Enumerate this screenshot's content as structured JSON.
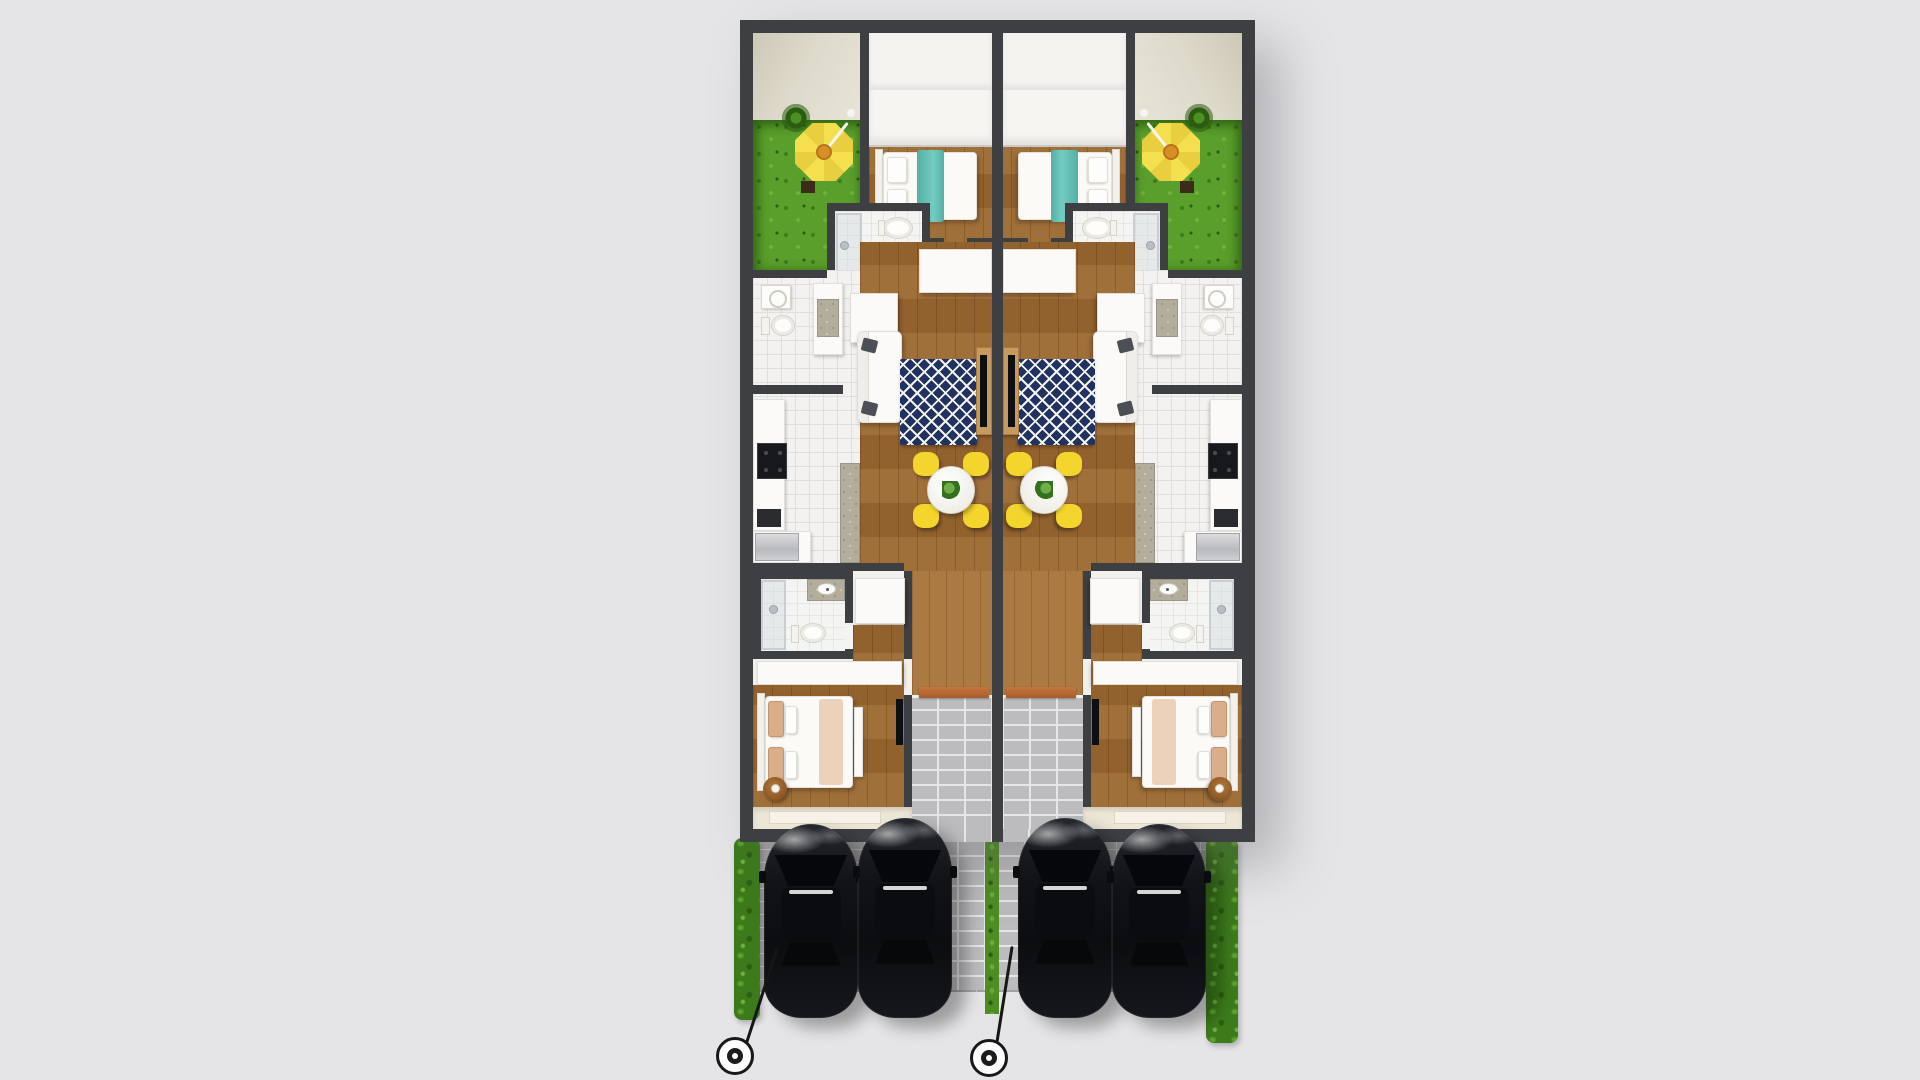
{
  "scene": {
    "title": "Duplex floor plan - top-down 3D render",
    "view": "top-down aerial",
    "building": {
      "type": "mirrored duplex, two identical units",
      "units": [
        "unit-left",
        "unit-right"
      ],
      "rooms_per_unit": [
        {
          "name": "patio-garden",
          "floor": "grass",
          "items": [
            "cantilever-umbrella",
            "palm-plant",
            "umbrella-base"
          ]
        },
        {
          "name": "bedroom-1",
          "floor": "wood",
          "items": [
            "wardrobe-row",
            "double-bed-with-teal-throw",
            "pillows"
          ]
        },
        {
          "name": "ensuite-bathroom",
          "floor": "white-tile",
          "items": [
            "glass-shower",
            "toilet",
            "granite-vanity-sink"
          ]
        },
        {
          "name": "laundry-wc",
          "floor": "white-tile",
          "items": [
            "washing-machine",
            "toilet",
            "granite-counter"
          ]
        },
        {
          "name": "kitchen",
          "floor": "white-tile",
          "items": [
            "wall-counter",
            "black-cooktop",
            "dishwasher",
            "fridge",
            "granite-island-bar",
            "bar-stools-x3"
          ]
        },
        {
          "name": "living-room",
          "floor": "wood",
          "items": [
            "white-sofa",
            "dark-accent-pillows-x2",
            "navy-trellis-rug",
            "wood-tv-sideboard",
            "flat-tv"
          ]
        },
        {
          "name": "dining-area",
          "floor": "wood",
          "items": [
            "round-white-table",
            "yellow-chairs-x4",
            "table-plant"
          ]
        },
        {
          "name": "bathroom-2",
          "floor": "white-tile",
          "items": [
            "glass-shower",
            "toilet",
            "granite-vanity-sink"
          ]
        },
        {
          "name": "hallway",
          "floor": "wood",
          "items": [
            "closet-left",
            "closet-right",
            "white-dresser"
          ]
        },
        {
          "name": "bedroom-2",
          "floor": "wood",
          "items": [
            "double-bed-tan-pillows",
            "foot-bench",
            "drum-side-table-with-lamp",
            "wall-tv"
          ]
        },
        {
          "name": "porch",
          "floor": "cream",
          "items": [
            "door-mat"
          ]
        },
        {
          "name": "entry-walkway",
          "floor": "light-brick-pavers",
          "items": [
            "orange-door-threshold"
          ]
        }
      ]
    },
    "exterior": {
      "driveway_surface": "grey brick pavers",
      "cars": [
        {
          "color": "black",
          "position": "left-unit bay 1"
        },
        {
          "color": "black",
          "position": "left-unit bay 2"
        },
        {
          "color": "black",
          "position": "right-unit bay 1"
        },
        {
          "color": "black",
          "position": "right-unit bay 2"
        }
      ],
      "street_lamps": 2,
      "hedges": [
        "left edge",
        "right edge"
      ],
      "lawn_divider_strip": "thin green strip between driveways"
    },
    "counts": {
      "units": 2,
      "umbrellas": 2,
      "dining_tables": 2,
      "dining_chairs": 8,
      "beds": 4,
      "bathrooms": 6,
      "cars": 4,
      "lamps": 2
    }
  },
  "colors": {
    "bg": "#e5e5e7",
    "wall": "#3e3f43",
    "interior": "#f1f0ed",
    "wood": "#9a6832",
    "wood-light": "#aa7a42",
    "tile": "#f3f2f0",
    "tile-line": "#e1dfdc",
    "grass": "#5a9e2b",
    "grass-dark": "#3f7a1a",
    "hedge": "#3c7a1b",
    "umbrella": "#f4e04e",
    "umbrella2": "#e9cf3f",
    "umb-hub": "#d78f25",
    "teal": "#62bdb4",
    "navy": "#223260",
    "ruglines": "#f2f2ef",
    "chair": "#f3d52e",
    "granite": "#b3ae9c",
    "white-furn": "#fbfaf8",
    "paver": "#a2a2a4",
    "paver-joint": "#c6c6c8",
    "brick": "#bcbcbe",
    "brick-joint": "#e6e6e8",
    "porch": "#ece6d7",
    "doormat": "#f6f2e7",
    "door": "#bc6e38",
    "car": "#121317",
    "beige1": "#cdc8b6",
    "beige2": "#e7e3d6",
    "dark-obj": "#2b2c30"
  }
}
